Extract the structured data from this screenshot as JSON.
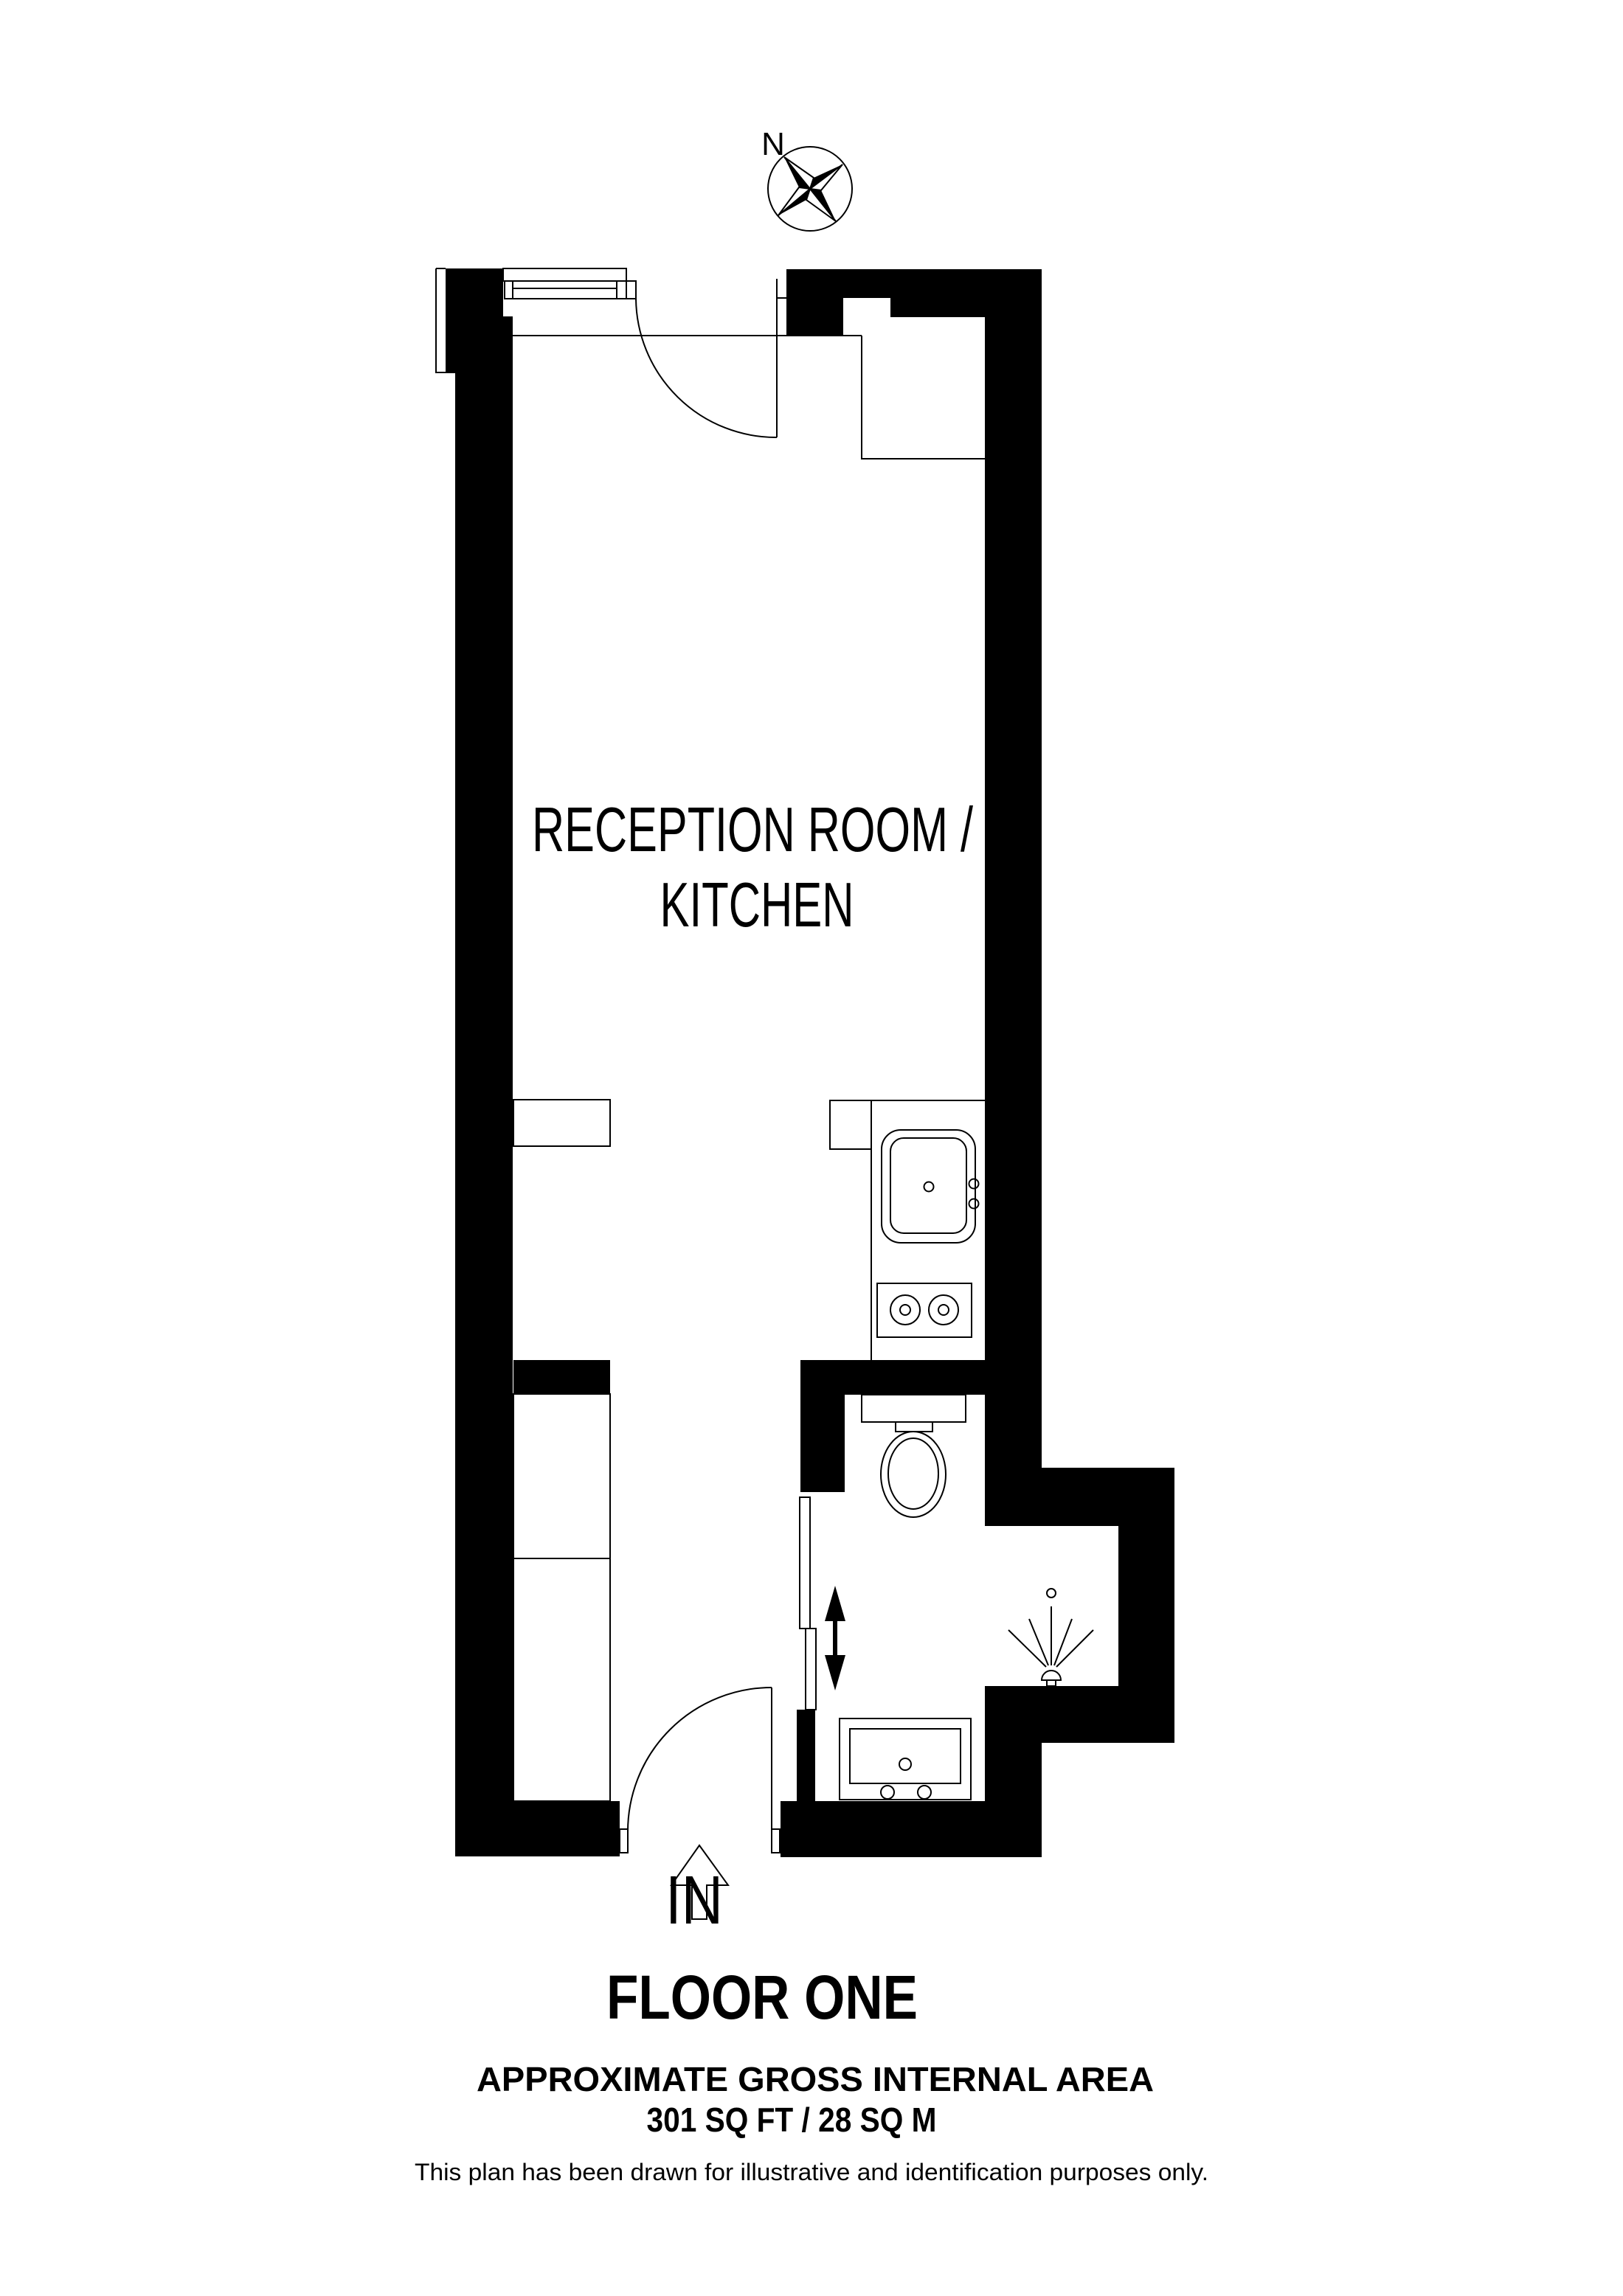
{
  "compass": {
    "north_label": "N"
  },
  "plan": {
    "room_label_line1": "RECEPTION ROOM /",
    "room_label_line2": "KITCHEN",
    "entrance_label": "IN"
  },
  "footer": {
    "floor_title": "FLOOR ONE",
    "area_heading": "APPROXIMATE GROSS INTERNAL AREA",
    "area_value": "301 SQ FT / 28 SQ M",
    "disclaimer": "This plan has been drawn for illustrative and identification purposes only."
  },
  "colors": {
    "wall": "#000000",
    "line": "#000000",
    "background": "#ffffff"
  }
}
